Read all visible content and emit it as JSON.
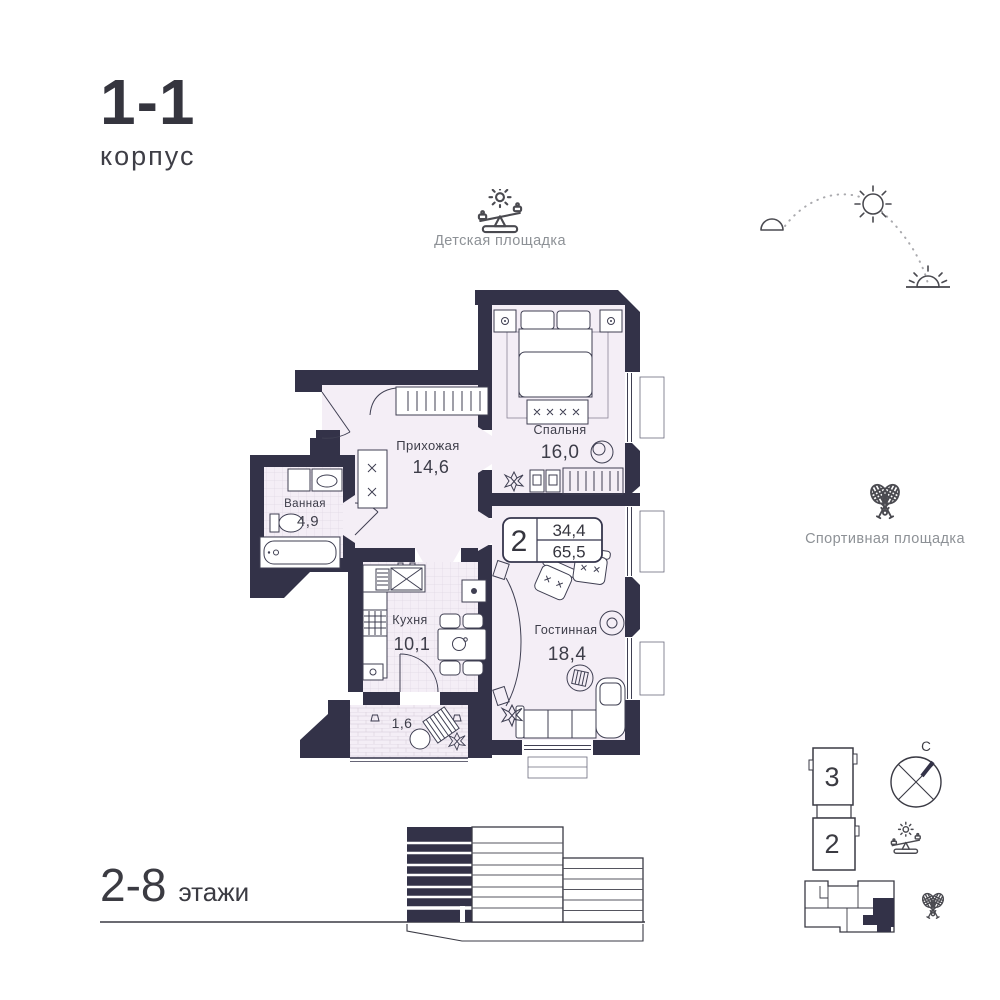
{
  "colors": {
    "wall": "#333248",
    "floor": "#f4eef6",
    "text_dark": "#3a3a44",
    "text_muted": "#8d9196"
  },
  "header": {
    "title": "1-1",
    "subtitle": "корпус"
  },
  "amenities": {
    "playground_label": "Детская площадка",
    "sports_label": "Спортивная площадка"
  },
  "apartment": {
    "rooms_count": "2",
    "area_living": "34,4",
    "area_total": "65,5"
  },
  "plan": {
    "hallway_name": "Прихожая",
    "hallway_area": "14,6",
    "bedroom_name": "Спальня",
    "bedroom_area": "16,0",
    "bathroom_name": "Ванная",
    "bathroom_area": "4,9",
    "kitchen_name": "Кухня",
    "kitchen_area": "10,1",
    "living_name": "Гостинная",
    "living_area": "18,4",
    "balcony_area": "1,6"
  },
  "floors": {
    "range": "2-8",
    "word": "этажи"
  },
  "site": {
    "building_3": "3",
    "building_2": "2",
    "compass_north": "С"
  },
  "icons": {
    "playground": "seesaw-with-sun-icon",
    "sports": "crossed-rackets-icon",
    "compass": "compass-north-icon",
    "sun_path": "sunrise-sun-sunset-arc"
  }
}
